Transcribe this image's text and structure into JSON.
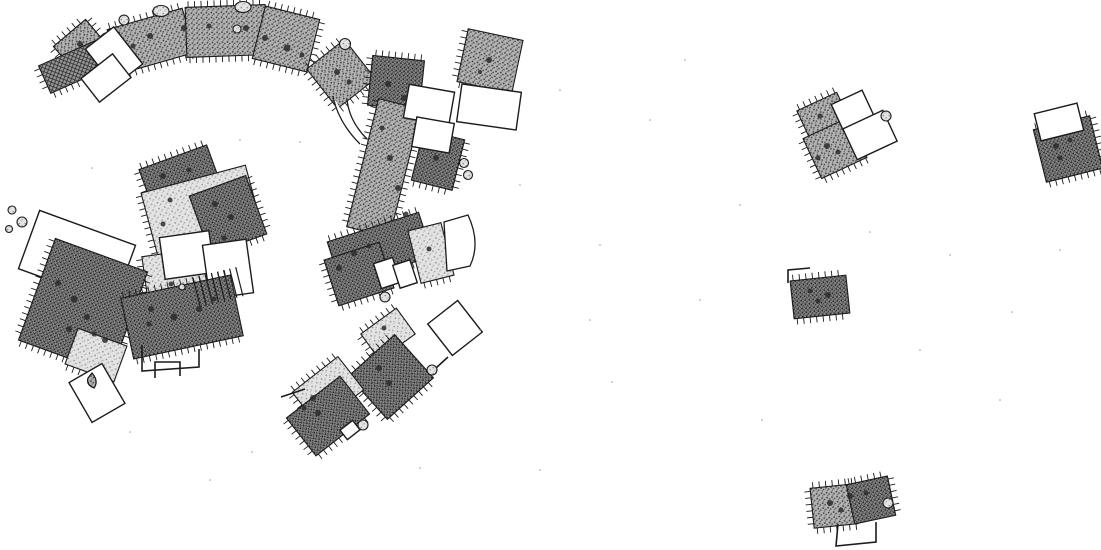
{
  "plan": {
    "canvas": {
      "width": 1101,
      "height": 550
    },
    "colors": {
      "background": "#ffffff",
      "stroke": "#1c1c1c",
      "stipple_dark_base": "#8c8c8c",
      "stipple_mid_base": "#b3b3b3",
      "stipple_light_base": "#e3e3e3",
      "crosshatch_base": "#969696",
      "hearth_spot": "#2b2b2b",
      "speck": "#9a9a9a"
    },
    "buildings": [
      {
        "name": "house-nw-square",
        "x": 62,
        "y": 28,
        "w": 42,
        "h": 42,
        "rot": -40,
        "fill": "mid",
        "ticks": [
          "top",
          "left",
          "right"
        ]
      },
      {
        "name": "house-nw-hatched-annex",
        "x": 42,
        "y": 52,
        "w": 62,
        "h": 30,
        "rot": -24,
        "fill": "cross",
        "ticks": [
          "left",
          "bottom"
        ]
      },
      {
        "name": "arc-house-west",
        "x": 112,
        "y": 18,
        "w": 78,
        "h": 46,
        "rot": -16,
        "fill": "mid",
        "ticks": [
          "top",
          "bottom"
        ]
      },
      {
        "name": "arc-house-center",
        "x": 186,
        "y": 6,
        "w": 80,
        "h": 50,
        "rot": -2,
        "fill": "mid",
        "ticks": [
          "top",
          "bottom"
        ]
      },
      {
        "name": "arc-house-east",
        "x": 258,
        "y": 12,
        "w": 56,
        "h": 54,
        "rot": 14,
        "fill": "mid",
        "ticks": [
          "top",
          "right",
          "bottom"
        ]
      },
      {
        "name": "room-nw-outline-a",
        "x": 96,
        "y": 33,
        "w": 36,
        "h": 47,
        "rot": -38,
        "fill": "none"
      },
      {
        "name": "room-nw-outline-b",
        "x": 86,
        "y": 63,
        "w": 40,
        "h": 30,
        "rot": -38,
        "fill": "none"
      },
      {
        "name": "house-north-square",
        "x": 317,
        "y": 49,
        "w": 48,
        "h": 50,
        "rot": -38,
        "fill": "mid",
        "ticks": [
          "top",
          "left",
          "bottom"
        ]
      },
      {
        "name": "house-ne-dark",
        "x": 370,
        "y": 58,
        "w": 52,
        "h": 50,
        "rot": 6,
        "fill": "dark",
        "ticks": [
          "top",
          "left"
        ]
      },
      {
        "name": "house-east-band",
        "x": 362,
        "y": 102,
        "w": 44,
        "h": 132,
        "rot": 14,
        "fill": "mid",
        "ticks": [
          "left",
          "right"
        ]
      },
      {
        "name": "house-east-mid",
        "x": 417,
        "y": 134,
        "w": 42,
        "h": 52,
        "rot": 14,
        "fill": "dark",
        "ticks": [
          "right",
          "bottom"
        ]
      },
      {
        "name": "room-ne-outline-a",
        "x": 406,
        "y": 88,
        "w": 46,
        "h": 34,
        "rot": 10,
        "fill": "none"
      },
      {
        "name": "room-ne-outline-b",
        "x": 414,
        "y": 120,
        "w": 38,
        "h": 30,
        "rot": 10,
        "fill": "none"
      },
      {
        "name": "house-ne-detached",
        "x": 462,
        "y": 34,
        "w": 56,
        "h": 54,
        "rot": 12,
        "fill": "mid",
        "ticks": [
          "left",
          "bottom"
        ]
      },
      {
        "name": "room-ne-detached-outline",
        "x": 459,
        "y": 88,
        "w": 60,
        "h": 38,
        "rot": 8,
        "fill": "none"
      },
      {
        "name": "house-center-north",
        "x": 144,
        "y": 156,
        "w": 72,
        "h": 42,
        "rot": -20,
        "fill": "dark",
        "ticks": [
          "top",
          "left"
        ]
      },
      {
        "name": "house-center-light",
        "x": 148,
        "y": 178,
        "w": 108,
        "h": 68,
        "rot": -15,
        "fill": "light",
        "ticks": [
          "left"
        ]
      },
      {
        "name": "house-center-dark-wing",
        "x": 198,
        "y": 184,
        "w": 60,
        "h": 62,
        "rot": -20,
        "fill": "dark",
        "ticks": [
          "right",
          "bottom"
        ]
      },
      {
        "name": "house-center-south-light",
        "x": 146,
        "y": 252,
        "w": 64,
        "h": 64,
        "rot": -8,
        "fill": "light",
        "ticks": [
          "left",
          "bottom"
        ]
      },
      {
        "name": "room-center-outline-a",
        "x": 162,
        "y": 234,
        "w": 50,
        "h": 42,
        "rot": -8,
        "fill": "none"
      },
      {
        "name": "room-center-outline-b",
        "x": 206,
        "y": 242,
        "w": 44,
        "h": 54,
        "rot": -8,
        "fill": "none"
      },
      {
        "name": "house-west-annex-outline",
        "x": 26,
        "y": 226,
        "w": 102,
        "h": 62,
        "rot": 20,
        "fill": "none"
      },
      {
        "name": "house-west-main",
        "x": 34,
        "y": 252,
        "w": 98,
        "h": 108,
        "rot": 20,
        "fill": "dark",
        "ticks": [
          "left",
          "right",
          "bottom"
        ]
      },
      {
        "name": "house-west-light-end",
        "x": 70,
        "y": 336,
        "w": 52,
        "h": 38,
        "rot": 20,
        "fill": "light",
        "ticks": [
          "bottom"
        ]
      },
      {
        "name": "room-sw-outline",
        "x": 78,
        "y": 370,
        "w": 38,
        "h": 46,
        "rot": -30,
        "fill": "none"
      },
      {
        "name": "house-south-center",
        "x": 126,
        "y": 286,
        "w": 112,
        "h": 62,
        "rot": -12,
        "fill": "dark",
        "ticks": [
          "top",
          "bottom"
        ]
      },
      {
        "name": "house-fan-dark",
        "x": 332,
        "y": 226,
        "w": 96,
        "h": 46,
        "rot": -18,
        "fill": "dark",
        "ticks": [
          "top",
          "bottom"
        ]
      },
      {
        "name": "house-fan-dark-sw",
        "x": 330,
        "y": 250,
        "w": 58,
        "h": 48,
        "rot": -18,
        "fill": "dark",
        "ticks": [
          "left",
          "bottom"
        ]
      },
      {
        "name": "house-fan-light",
        "x": 414,
        "y": 226,
        "w": 34,
        "h": 54,
        "rot": -14,
        "fill": "light",
        "ticks": [
          "bottom"
        ]
      },
      {
        "name": "room-fan-outline-a",
        "x": 377,
        "y": 260,
        "w": 20,
        "h": 26,
        "rot": -18,
        "fill": "none"
      },
      {
        "name": "room-fan-outline-b",
        "x": 396,
        "y": 262,
        "w": 18,
        "h": 24,
        "rot": -18,
        "fill": "none"
      },
      {
        "name": "house-sse-light-room",
        "x": 366,
        "y": 318,
        "w": 44,
        "h": 32,
        "rot": -36,
        "fill": "light",
        "ticks": [
          "top",
          "left"
        ]
      },
      {
        "name": "house-sse-dark",
        "x": 360,
        "y": 348,
        "w": 62,
        "h": 58,
        "rot": -42,
        "fill": "dark",
        "ticks": [
          "top",
          "left",
          "bottom"
        ]
      },
      {
        "name": "room-sse-outline-diamond",
        "x": 436,
        "y": 308,
        "w": 38,
        "h": 40,
        "rot": -38,
        "fill": "none"
      },
      {
        "name": "house-s-light",
        "x": 299,
        "y": 370,
        "w": 58,
        "h": 42,
        "rot": -38,
        "fill": "light",
        "ticks": [
          "top",
          "left"
        ]
      },
      {
        "name": "house-s-dark",
        "x": 294,
        "y": 392,
        "w": 68,
        "h": 48,
        "rot": -38,
        "fill": "dark",
        "ticks": [
          "left",
          "bottom"
        ]
      },
      {
        "name": "room-s-small-outline",
        "x": 342,
        "y": 424,
        "w": 16,
        "h": 12,
        "rot": -38,
        "fill": "none"
      },
      {
        "name": "house-r1-room-nw",
        "x": 802,
        "y": 100,
        "w": 44,
        "h": 34,
        "rot": -25,
        "fill": "mid",
        "ticks": [
          "top",
          "left"
        ]
      },
      {
        "name": "house-r1-room-sw",
        "x": 810,
        "y": 126,
        "w": 50,
        "h": 44,
        "rot": -25,
        "fill": "mid",
        "ticks": [
          "left",
          "bottom"
        ]
      },
      {
        "name": "room-r1-outline-ne",
        "x": 836,
        "y": 96,
        "w": 34,
        "h": 30,
        "rot": -25,
        "fill": "none"
      },
      {
        "name": "room-r1-outline-se",
        "x": 848,
        "y": 118,
        "w": 44,
        "h": 34,
        "rot": -25,
        "fill": "none"
      },
      {
        "name": "house-r2",
        "x": 1039,
        "y": 122,
        "w": 58,
        "h": 54,
        "rot": -14,
        "fill": "dark",
        "ticks": [
          "top",
          "right",
          "bottom"
        ]
      },
      {
        "name": "room-r2-annex-outline",
        "x": 1037,
        "y": 108,
        "w": 44,
        "h": 28,
        "rot": -14,
        "fill": "none"
      },
      {
        "name": "house-r3",
        "x": 792,
        "y": 278,
        "w": 56,
        "h": 38,
        "rot": -6,
        "fill": "dark",
        "ticks": [
          "top",
          "bottom"
        ]
      },
      {
        "name": "house-r4-west",
        "x": 812,
        "y": 486,
        "w": 44,
        "h": 40,
        "rot": -6,
        "fill": "mid",
        "ticks": [
          "top",
          "left",
          "bottom"
        ]
      },
      {
        "name": "house-r4-east",
        "x": 850,
        "y": 480,
        "w": 42,
        "h": 40,
        "rot": -12,
        "fill": "dark",
        "ticks": [
          "top",
          "right"
        ]
      }
    ],
    "ladders": [
      {
        "name": "ladder-hatch-center",
        "x": 196,
        "y": 272,
        "w": 44,
        "h": 30,
        "rot": -14,
        "lines": 8
      }
    ],
    "walls": [
      {
        "name": "wall-center-u",
        "points": [
          [
            142,
            345
          ],
          [
            142,
            371
          ],
          [
            199,
            367
          ],
          [
            199,
            349
          ]
        ]
      },
      {
        "name": "wall-r4-u",
        "points": [
          [
            838,
            524
          ],
          [
            836,
            546
          ],
          [
            876,
            542
          ],
          [
            876,
            522
          ]
        ]
      },
      {
        "name": "wall-r3-flag",
        "points": [
          [
            788,
            283
          ],
          [
            788,
            270
          ],
          [
            810,
            268
          ]
        ]
      },
      {
        "name": "wall-s-stub",
        "points": [
          [
            281,
            397
          ],
          [
            305,
            389
          ]
        ]
      },
      {
        "name": "wall-s-tick",
        "points": [
          [
            436,
            368
          ],
          [
            448,
            357
          ]
        ]
      },
      {
        "name": "wall-sw-open-rect",
        "points": [
          [
            155,
            378
          ],
          [
            155,
            362
          ],
          [
            180,
            362
          ],
          [
            180,
            376
          ]
        ]
      }
    ],
    "paths": [
      {
        "name": "path-connector-west",
        "d": "M333,96 Q338,122 360,144",
        "fill": "none"
      },
      {
        "name": "path-connector-east",
        "d": "M347,99 Q349,121 367,139",
        "fill": "none"
      },
      {
        "name": "room-fan-arc-outline",
        "d": "M444,222 L468,215 Q481,243 470,266 L447,271 Z",
        "fill": "#ffffff"
      },
      {
        "name": "feature-teardrop",
        "d": "M92,373 Q99,381 94,388 Q86,385 88,378 Z",
        "fill": "mid"
      }
    ],
    "markers": [
      {
        "name": "feature-marker",
        "x": 124,
        "y": 20,
        "rx": 5,
        "ry": 5
      },
      {
        "name": "feature-marker",
        "x": 161,
        "y": 11,
        "rx": 8,
        "ry": 5.5
      },
      {
        "name": "feature-marker",
        "x": 243,
        "y": 7,
        "rx": 8,
        "ry": 5.5
      },
      {
        "name": "feature-marker",
        "x": 345,
        "y": 44,
        "rx": 5.5,
        "ry": 5.5
      },
      {
        "name": "feature-marker",
        "x": 237,
        "y": 29,
        "rx": 4,
        "ry": 4
      },
      {
        "name": "feature-marker",
        "x": 385,
        "y": 297,
        "rx": 5,
        "ry": 5
      },
      {
        "name": "feature-marker",
        "x": 363,
        "y": 425,
        "rx": 5,
        "ry": 5
      },
      {
        "name": "feature-marker",
        "x": 432,
        "y": 370,
        "rx": 5,
        "ry": 5
      },
      {
        "name": "feature-marker",
        "x": 886,
        "y": 116,
        "rx": 5,
        "ry": 5
      },
      {
        "name": "feature-marker",
        "x": 888,
        "y": 503,
        "rx": 5,
        "ry": 5
      },
      {
        "name": "feature-dot",
        "x": 464,
        "y": 163,
        "rx": 4.5,
        "ry": 4.5
      },
      {
        "name": "feature-dot",
        "x": 468,
        "y": 175,
        "rx": 4.5,
        "ry": 4.5
      },
      {
        "name": "feature-dot",
        "x": 12,
        "y": 210,
        "rx": 4,
        "ry": 4
      },
      {
        "name": "feature-dot",
        "x": 22,
        "y": 222,
        "rx": 5,
        "ry": 5
      },
      {
        "name": "feature-dot",
        "x": 9,
        "y": 229,
        "rx": 3.5,
        "ry": 3.5
      },
      {
        "name": "feature-dot",
        "x": 182,
        "y": 287,
        "rx": 3,
        "ry": 3
      }
    ],
    "spots": [
      [
        150,
        36,
        3
      ],
      [
        184,
        28,
        3
      ],
      [
        209,
        26,
        2.5
      ],
      [
        246,
        28,
        3
      ],
      [
        265,
        38,
        3
      ],
      [
        287,
        48,
        3.5
      ],
      [
        302,
        55,
        2.5
      ],
      [
        133,
        46,
        2.5
      ],
      [
        80,
        44,
        3
      ],
      [
        337,
        72,
        3
      ],
      [
        349,
        82,
        2.5
      ],
      [
        388,
        84,
        3
      ],
      [
        404,
        98,
        3
      ],
      [
        489,
        60,
        3
      ],
      [
        480,
        72,
        2
      ],
      [
        382,
        128,
        2.5
      ],
      [
        390,
        158,
        3
      ],
      [
        398,
        188,
        3
      ],
      [
        406,
        214,
        2.5
      ],
      [
        436,
        158,
        3
      ],
      [
        163,
        176,
        3
      ],
      [
        189,
        170,
        2.5
      ],
      [
        170,
        200,
        2.5
      ],
      [
        163,
        224,
        2.5
      ],
      [
        215,
        204,
        3
      ],
      [
        231,
        217,
        3
      ],
      [
        224,
        238,
        2.5
      ],
      [
        171,
        284,
        2.5
      ],
      [
        58,
        283,
        3
      ],
      [
        74,
        299,
        3.5
      ],
      [
        87,
        317,
        3
      ],
      [
        69,
        329,
        3
      ],
      [
        94,
        334,
        2.5
      ],
      [
        105,
        340,
        3
      ],
      [
        151,
        309,
        3
      ],
      [
        174,
        317,
        3.5
      ],
      [
        199,
        309,
        3
      ],
      [
        214,
        299,
        2.5
      ],
      [
        149,
        324,
        2.5
      ],
      [
        354,
        253,
        3
      ],
      [
        339,
        268,
        3
      ],
      [
        369,
        246,
        2.5
      ],
      [
        429,
        249,
        2.5
      ],
      [
        313,
        398,
        3
      ],
      [
        318,
        413,
        3
      ],
      [
        304,
        408,
        2.5
      ],
      [
        379,
        368,
        3
      ],
      [
        389,
        383,
        3
      ],
      [
        384,
        328,
        2.5
      ],
      [
        820,
        116,
        2.5
      ],
      [
        827,
        146,
        3
      ],
      [
        818,
        158,
        2.5
      ],
      [
        838,
        152,
        2.5
      ],
      [
        1056,
        146,
        3
      ],
      [
        1070,
        140,
        2.5
      ],
      [
        1060,
        158,
        2.5
      ],
      [
        810,
        291,
        2.5
      ],
      [
        828,
        295,
        3
      ],
      [
        818,
        301,
        2.5
      ],
      [
        830,
        503,
        3
      ],
      [
        850,
        496,
        3
      ],
      [
        841,
        510,
        2.5
      ],
      [
        866,
        493,
        2.5
      ]
    ],
    "specks": [
      [
        240,
        140
      ],
      [
        520,
        185
      ],
      [
        600,
        245
      ],
      [
        700,
        300
      ],
      [
        480,
        330
      ],
      [
        560,
        90
      ],
      [
        130,
        432
      ],
      [
        252,
        452
      ],
      [
        420,
        468
      ],
      [
        650,
        120
      ],
      [
        740,
        205
      ],
      [
        950,
        255
      ],
      [
        1000,
        400
      ],
      [
        762,
        420
      ],
      [
        540,
        470
      ],
      [
        92,
        168
      ],
      [
        300,
        142
      ],
      [
        612,
        382
      ],
      [
        870,
        232
      ],
      [
        1012,
        312
      ],
      [
        685,
        60
      ],
      [
        920,
        350
      ],
      [
        1060,
        250
      ],
      [
        590,
        320
      ],
      [
        210,
        480
      ]
    ]
  }
}
